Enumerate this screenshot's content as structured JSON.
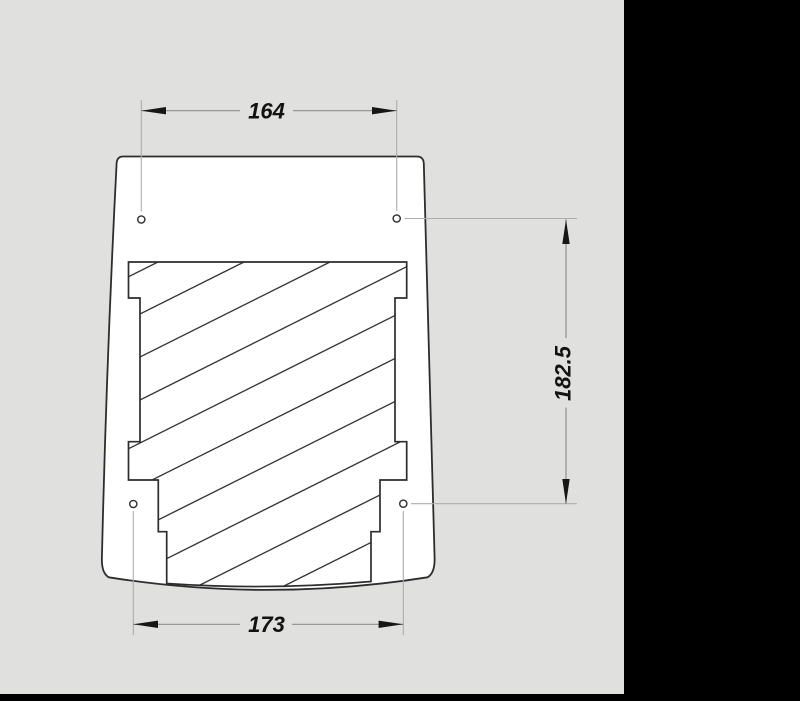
{
  "drawing": {
    "kind": "technical-drawing-front-view",
    "colors": {
      "canvas_background": "#e0e0de",
      "part_fill": "#ffffff",
      "outline": "#2d2d2d",
      "hatch": "#383838",
      "extension_line": "#adadab",
      "dimension_line": "#8e8e8c",
      "dimension_text": "#121212",
      "side_panel": "#000000",
      "bottom_bar": "#000000"
    },
    "dimensions": {
      "top_width": {
        "value": "164",
        "orientation": "horizontal"
      },
      "bottom_width": {
        "value": "173",
        "orientation": "horizontal"
      },
      "right_height": {
        "value": "182.5",
        "orientation": "vertical"
      }
    },
    "holes": [
      {
        "name": "top-left"
      },
      {
        "name": "top-right"
      },
      {
        "name": "bottom-left"
      },
      {
        "name": "bottom-right"
      }
    ]
  }
}
